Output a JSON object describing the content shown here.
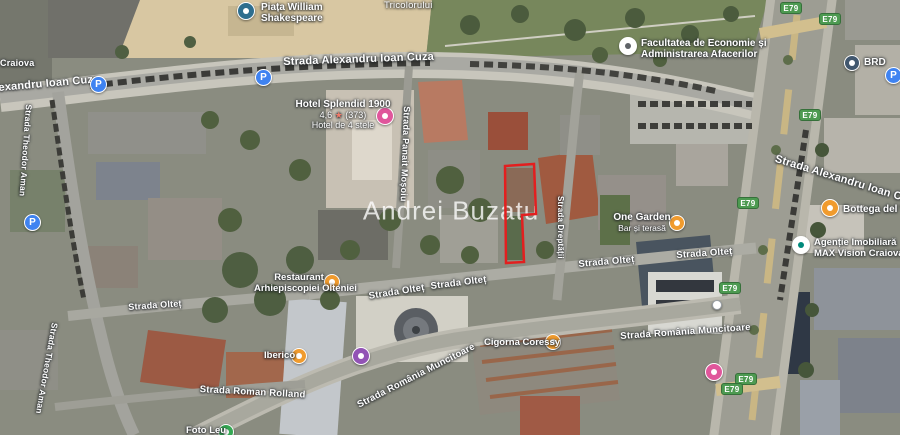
{
  "watermark": "Andrei Buzatu",
  "annotation": {
    "parcel_outline_color": "#e31f1f"
  },
  "streets": [
    {
      "label": "Craiova"
    },
    {
      "label": "exandru Ioan Cuza"
    },
    {
      "label": "Strada Alexandru Ioan Cuza"
    },
    {
      "label": "Tricolorului"
    },
    {
      "label": "Strada Alexandru Ioan Cuza"
    },
    {
      "label": "Strada Theodor Aman"
    },
    {
      "label": "Strada Panait Moșoiu"
    },
    {
      "label": "Strada Dreptății"
    },
    {
      "label": "Strada Olteț"
    },
    {
      "label": "Strada Olteț"
    },
    {
      "label": "Strada Olteț"
    },
    {
      "label": "Strada Olteț"
    },
    {
      "label": "Strada Olteț"
    },
    {
      "label": "Strada Theodor Aman"
    },
    {
      "label": "Strada Roman Rolland"
    },
    {
      "label": "Strada România Muncitoare"
    },
    {
      "label": "Strada România Muncitoare"
    }
  ],
  "pois": [
    {
      "line1": "Piața William",
      "line2": "Shakespeare",
      "icon": "square-attraction-icon",
      "color": "#2e6e8e"
    },
    {
      "name": "Hotel Splendid 1900",
      "rating_value": "4,6",
      "rating_star": "★",
      "rating_count": "(373)",
      "category": "Hotel de 4 stele",
      "icon": "hotel-icon",
      "color": "#e0569b"
    },
    {
      "line1": "Facultatea de Economie și",
      "line2": "Administrarea Afacerilor",
      "icon": "university-icon",
      "color": "#ffffff"
    },
    {
      "name": "BRD",
      "icon": "bank-icon",
      "color": "#41576e"
    },
    {
      "line1": "One Garden",
      "line2": "Bar și terasă",
      "icon": "bar-icon",
      "color": "#f09b2e"
    },
    {
      "name": "Bottega del Vino",
      "icon": "restaurant-icon",
      "color": "#f09b2e"
    },
    {
      "line1": "Agenție Imobiliară",
      "line2": "MAX Vision Craiova",
      "icon": "business-icon",
      "color": "#ffffff"
    },
    {
      "line1": "Restaurant",
      "line2": "Arhiepiscopiei Olteniei",
      "icon": "restaurant-icon",
      "color": "#f09b2e"
    },
    {
      "name": "Cigorna Coressy",
      "icon": "cafe-icon",
      "color": "#f09b2e"
    },
    {
      "name": "Iberico",
      "icon": "restaurant-icon",
      "color": "#f09b2e"
    },
    {
      "name": "Foto Leu",
      "icon": "shop-icon",
      "color": "#34a853"
    }
  ],
  "badges": {
    "route": "E79",
    "color": "#4d9a51"
  },
  "parking": {
    "label": "P",
    "color": "#3f83f1"
  }
}
